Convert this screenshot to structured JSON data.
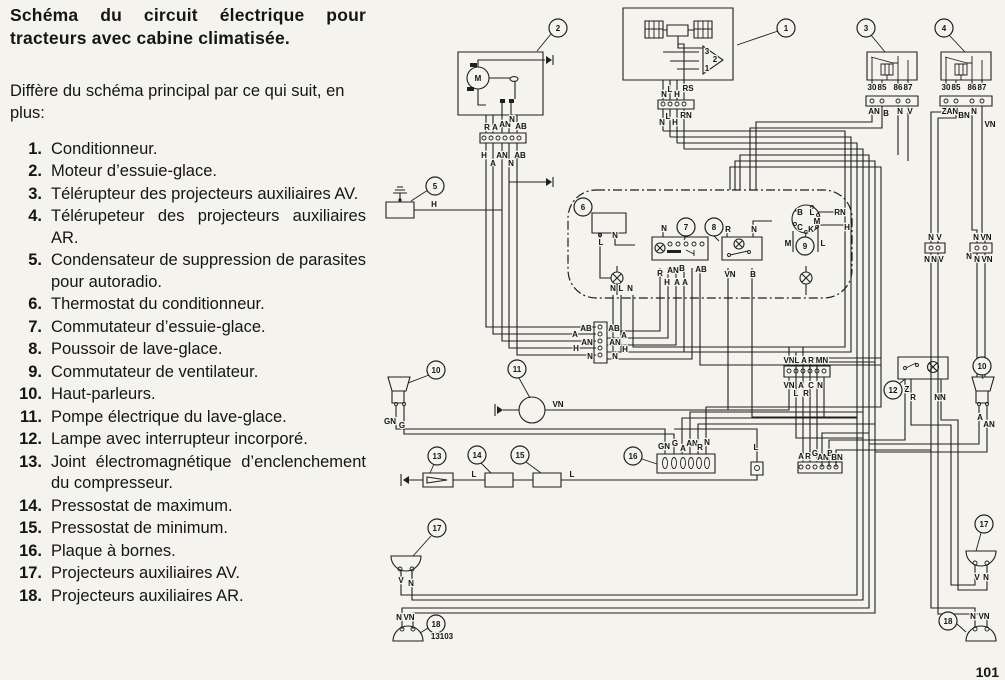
{
  "page": {
    "number": "101",
    "figure_code": "13103"
  },
  "legend": {
    "title": "Schéma du circuit électrique pour tracteurs avec cabine climatisée.",
    "intro": "Diffère du schéma principal par ce qui suit, en plus:",
    "items": [
      {
        "num": "1.",
        "text": "Conditionneur."
      },
      {
        "num": "2.",
        "text": "Moteur d’essuie-glace."
      },
      {
        "num": "3.",
        "text": "Télérupteur des projecteurs auxiliaires AV."
      },
      {
        "num": "4.",
        "text": "Télérupeteur des projecteurs auxiliaires AR."
      },
      {
        "num": "5.",
        "text": "Condensateur de suppression de parasites pour autoradio."
      },
      {
        "num": "6.",
        "text": "Thermostat du conditionneur."
      },
      {
        "num": "7.",
        "text": "Commutateur d’essuie-glace."
      },
      {
        "num": "8.",
        "text": "Poussoir de lave-glace."
      },
      {
        "num": "9.",
        "text": "Commutateur de ventilateur."
      },
      {
        "num": "10.",
        "text": "Haut-parleurs."
      },
      {
        "num": "11.",
        "text": "Pompe électrique du lave-glace."
      },
      {
        "num": "12.",
        "text": "Lampe avec interrupteur incorporé."
      },
      {
        "num": "13.",
        "text": "Joint électromagnétique d’enclenchement du compresseur."
      },
      {
        "num": "14.",
        "text": "Pressostat de maximum."
      },
      {
        "num": "15.",
        "text": "Pressostat de minimum."
      },
      {
        "num": "16.",
        "text": "Plaque à bornes."
      },
      {
        "num": "17.",
        "text": "Projecteurs auxiliaires AV."
      },
      {
        "num": "18.",
        "text": "Projecteurs auxiliaires AR."
      }
    ]
  },
  "diagram": {
    "colors": {
      "ink": "#1f1f1f",
      "paper": "#f4f3ee"
    },
    "callouts": [
      {
        "n": "1",
        "x": 786,
        "y": 28
      },
      {
        "n": "2",
        "x": 558,
        "y": 28
      },
      {
        "n": "3",
        "x": 866,
        "y": 28
      },
      {
        "n": "4",
        "x": 944,
        "y": 28
      },
      {
        "n": "5",
        "x": 435,
        "y": 186
      },
      {
        "n": "6",
        "x": 583,
        "y": 207
      },
      {
        "n": "7",
        "x": 686,
        "y": 227
      },
      {
        "n": "8",
        "x": 714,
        "y": 227
      },
      {
        "n": "9",
        "x": 805,
        "y": 246
      },
      {
        "n": "10",
        "x": 436,
        "y": 370
      },
      {
        "n": "11",
        "x": 517,
        "y": 369
      },
      {
        "n": "12",
        "x": 893,
        "y": 390
      },
      {
        "n": "13",
        "x": 437,
        "y": 456
      },
      {
        "n": "14",
        "x": 477,
        "y": 455
      },
      {
        "n": "15",
        "x": 520,
        "y": 455
      },
      {
        "n": "16",
        "x": 633,
        "y": 456
      },
      {
        "n": "10",
        "x": 982,
        "y": 366
      },
      {
        "n": "17",
        "x": 437,
        "y": 528
      },
      {
        "n": "17",
        "x": 984,
        "y": 524
      },
      {
        "n": "18",
        "x": 436,
        "y": 624
      },
      {
        "n": "18",
        "x": 948,
        "y": 621
      }
    ],
    "wire_labels": [
      {
        "t": "M",
        "x": 478,
        "y": 81,
        "s": 7
      },
      {
        "t": "R",
        "x": 487,
        "y": 130
      },
      {
        "t": "A",
        "x": 495,
        "y": 130
      },
      {
        "t": "AN",
        "x": 505,
        "y": 127
      },
      {
        "t": "N",
        "x": 512,
        "y": 122
      },
      {
        "t": "AB",
        "x": 521,
        "y": 129
      },
      {
        "t": "H",
        "x": 484,
        "y": 158
      },
      {
        "t": "A",
        "x": 493,
        "y": 166
      },
      {
        "t": "AN",
        "x": 502,
        "y": 158
      },
      {
        "t": "N",
        "x": 511,
        "y": 166
      },
      {
        "t": "AB",
        "x": 520,
        "y": 158
      },
      {
        "t": "3",
        "x": 707,
        "y": 54,
        "s": 6
      },
      {
        "t": "2",
        "x": 715,
        "y": 62,
        "s": 6
      },
      {
        "t": "1",
        "x": 707,
        "y": 71,
        "s": 6
      },
      {
        "t": "N",
        "x": 664,
        "y": 97
      },
      {
        "t": "L",
        "x": 670,
        "y": 92
      },
      {
        "t": "H",
        "x": 677,
        "y": 97
      },
      {
        "t": "RS",
        "x": 688,
        "y": 91
      },
      {
        "t": "N",
        "x": 662,
        "y": 125
      },
      {
        "t": "L",
        "x": 668,
        "y": 119
      },
      {
        "t": "H",
        "x": 675,
        "y": 125
      },
      {
        "t": "RN",
        "x": 686,
        "y": 118
      },
      {
        "t": "30",
        "x": 872,
        "y": 90,
        "s": 6
      },
      {
        "t": "85",
        "x": 882,
        "y": 90,
        "s": 6
      },
      {
        "t": "86",
        "x": 898,
        "y": 90,
        "s": 6
      },
      {
        "t": "87",
        "x": 908,
        "y": 90,
        "s": 6
      },
      {
        "t": "AN",
        "x": 874,
        "y": 114
      },
      {
        "t": "B",
        "x": 886,
        "y": 116
      },
      {
        "t": "N",
        "x": 900,
        "y": 114
      },
      {
        "t": "V",
        "x": 910,
        "y": 114
      },
      {
        "t": "30",
        "x": 946,
        "y": 90,
        "s": 6
      },
      {
        "t": "85",
        "x": 956,
        "y": 90,
        "s": 6
      },
      {
        "t": "86",
        "x": 972,
        "y": 90,
        "s": 6
      },
      {
        "t": "87",
        "x": 982,
        "y": 90,
        "s": 6
      },
      {
        "t": "ZAN",
        "x": 950,
        "y": 114
      },
      {
        "t": "BN",
        "x": 964,
        "y": 118
      },
      {
        "t": "N",
        "x": 974,
        "y": 114
      },
      {
        "t": "VN",
        "x": 990,
        "y": 127
      },
      {
        "t": "H",
        "x": 434,
        "y": 207
      },
      {
        "t": "L",
        "x": 601,
        "y": 245
      },
      {
        "t": "N",
        "x": 615,
        "y": 238
      },
      {
        "t": "N",
        "x": 664,
        "y": 231
      },
      {
        "t": "R",
        "x": 660,
        "y": 276
      },
      {
        "t": "AN",
        "x": 673,
        "y": 273
      },
      {
        "t": "B",
        "x": 682,
        "y": 271
      },
      {
        "t": "H",
        "x": 667,
        "y": 285
      },
      {
        "t": "A",
        "x": 677,
        "y": 285
      },
      {
        "t": "A",
        "x": 685,
        "y": 285
      },
      {
        "t": "AB",
        "x": 701,
        "y": 272
      },
      {
        "t": "R",
        "x": 728,
        "y": 232
      },
      {
        "t": "N",
        "x": 754,
        "y": 232
      },
      {
        "t": "VN",
        "x": 730,
        "y": 277
      },
      {
        "t": "B",
        "x": 753,
        "y": 277
      },
      {
        "t": "M",
        "x": 788,
        "y": 246
      },
      {
        "t": "L",
        "x": 823,
        "y": 246
      },
      {
        "t": "RN",
        "x": 840,
        "y": 215
      },
      {
        "t": "H",
        "x": 847,
        "y": 230
      },
      {
        "t": "B",
        "x": 800,
        "y": 215,
        "s": 5.5
      },
      {
        "t": "L",
        "x": 812,
        "y": 215,
        "s": 5.5
      },
      {
        "t": "M",
        "x": 817,
        "y": 224,
        "s": 5.5
      },
      {
        "t": "C",
        "x": 800,
        "y": 230,
        "s": 5.5
      },
      {
        "t": "K",
        "x": 811,
        "y": 232,
        "s": 5.5
      },
      {
        "t": "N",
        "x": 613,
        "y": 291
      },
      {
        "t": "L",
        "x": 621,
        "y": 291
      },
      {
        "t": "N",
        "x": 630,
        "y": 291
      },
      {
        "t": "A",
        "x": 575,
        "y": 337
      },
      {
        "t": "H",
        "x": 576,
        "y": 351
      },
      {
        "t": "AB",
        "x": 586,
        "y": 331
      },
      {
        "t": "AN",
        "x": 587,
        "y": 345
      },
      {
        "t": "N",
        "x": 590,
        "y": 359
      },
      {
        "t": "AB",
        "x": 614,
        "y": 331
      },
      {
        "t": "A",
        "x": 624,
        "y": 338
      },
      {
        "t": "AN",
        "x": 615,
        "y": 345
      },
      {
        "t": "H",
        "x": 625,
        "y": 352
      },
      {
        "t": "N",
        "x": 615,
        "y": 359
      },
      {
        "t": "VN",
        "x": 558,
        "y": 407
      },
      {
        "t": "GN",
        "x": 390,
        "y": 424
      },
      {
        "t": "G",
        "x": 402,
        "y": 428
      },
      {
        "t": "VN",
        "x": 789,
        "y": 363
      },
      {
        "t": "L",
        "x": 797,
        "y": 363
      },
      {
        "t": "A",
        "x": 804,
        "y": 363
      },
      {
        "t": "R",
        "x": 811,
        "y": 363
      },
      {
        "t": "MN",
        "x": 822,
        "y": 363
      },
      {
        "t": "VN",
        "x": 789,
        "y": 388
      },
      {
        "t": "A",
        "x": 801,
        "y": 388
      },
      {
        "t": "C",
        "x": 811,
        "y": 388
      },
      {
        "t": "N",
        "x": 820,
        "y": 388
      },
      {
        "t": "L",
        "x": 796,
        "y": 396
      },
      {
        "t": "R",
        "x": 806,
        "y": 396
      },
      {
        "t": "Z",
        "x": 907,
        "y": 392
      },
      {
        "t": "R",
        "x": 913,
        "y": 400
      },
      {
        "t": "NN",
        "x": 940,
        "y": 400
      },
      {
        "t": "A",
        "x": 980,
        "y": 420
      },
      {
        "t": "AN",
        "x": 989,
        "y": 427
      },
      {
        "t": "N",
        "x": 931,
        "y": 240
      },
      {
        "t": "V",
        "x": 939,
        "y": 240
      },
      {
        "t": "N",
        "x": 927,
        "y": 262
      },
      {
        "t": "N",
        "x": 934,
        "y": 262
      },
      {
        "t": "V",
        "x": 941,
        "y": 262
      },
      {
        "t": "N",
        "x": 976,
        "y": 240
      },
      {
        "t": "VN",
        "x": 986,
        "y": 240
      },
      {
        "t": "N",
        "x": 969,
        "y": 259
      },
      {
        "t": "N",
        "x": 977,
        "y": 262
      },
      {
        "t": "VN",
        "x": 987,
        "y": 262
      },
      {
        "t": "L",
        "x": 474,
        "y": 477
      },
      {
        "t": "L",
        "x": 572,
        "y": 477
      },
      {
        "t": "L",
        "x": 756,
        "y": 450
      },
      {
        "t": "GN",
        "x": 664,
        "y": 449
      },
      {
        "t": "G",
        "x": 675,
        "y": 446
      },
      {
        "t": "A",
        "x": 683,
        "y": 451
      },
      {
        "t": "AN",
        "x": 692,
        "y": 446
      },
      {
        "t": "R",
        "x": 700,
        "y": 450
      },
      {
        "t": "N",
        "x": 707,
        "y": 445
      },
      {
        "t": "A",
        "x": 801,
        "y": 459
      },
      {
        "t": "R",
        "x": 808,
        "y": 459
      },
      {
        "t": "G",
        "x": 815,
        "y": 456
      },
      {
        "t": "AN",
        "x": 823,
        "y": 460
      },
      {
        "t": "B",
        "x": 830,
        "y": 456
      },
      {
        "t": "BN",
        "x": 837,
        "y": 460
      },
      {
        "t": "V",
        "x": 401,
        "y": 583
      },
      {
        "t": "N",
        "x": 411,
        "y": 586
      },
      {
        "t": "N",
        "x": 399,
        "y": 620
      },
      {
        "t": "VN",
        "x": 409,
        "y": 620
      },
      {
        "t": "V",
        "x": 977,
        "y": 580
      },
      {
        "t": "N",
        "x": 986,
        "y": 580
      },
      {
        "t": "N",
        "x": 973,
        "y": 619
      },
      {
        "t": "VN",
        "x": 984,
        "y": 619
      },
      {
        "t": "13103",
        "x": 442,
        "y": 639,
        "s": 8.5,
        "w": "normal"
      }
    ]
  }
}
